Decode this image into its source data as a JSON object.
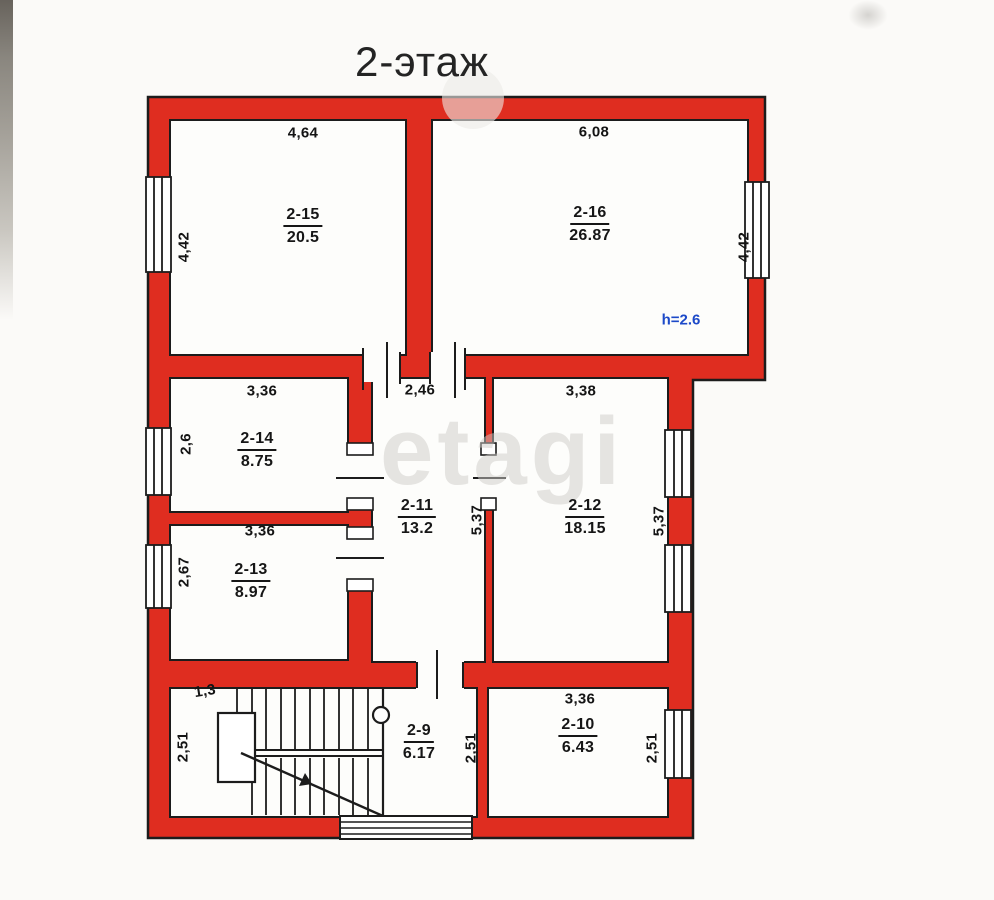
{
  "title": "2-этаж",
  "watermark": "etagi",
  "height_note": "h=2.6",
  "colors": {
    "wall_red": "#df2d20",
    "outline": "#1c1c1c",
    "note_blue": "#1c49c8"
  },
  "rooms": [
    {
      "id": "2-15",
      "area": "20.5"
    },
    {
      "id": "2-16",
      "area": "26.87"
    },
    {
      "id": "2-14",
      "area": "8.75"
    },
    {
      "id": "2-13",
      "area": "8.97"
    },
    {
      "id": "2-11",
      "area": "13.2"
    },
    {
      "id": "2-12",
      "area": "18.15"
    },
    {
      "id": "2-9",
      "area": "6.17"
    },
    {
      "id": "2-10",
      "area": "6.43"
    }
  ],
  "dimensions": {
    "room_2_15_width": "4,64",
    "room_2_16_width": "6,08",
    "room_2_15_depth": "4,42",
    "room_2_16_depth": "4,42",
    "room_2_14_width": "3,36",
    "corridor_width": "2,46",
    "room_2_12_width": "3,38",
    "room_2_14_depth": "2,6",
    "room_2_13_width": "3,36",
    "room_2_13_depth": "2,67",
    "corridor_depth": "5,37",
    "room_2_12_depth": "5,37",
    "stair_width": "1,3",
    "hall_depth": "2,51",
    "room_2_9_depth": "2,51",
    "room_2_10_width": "3,36",
    "room_2_10_depth": "2,51"
  }
}
